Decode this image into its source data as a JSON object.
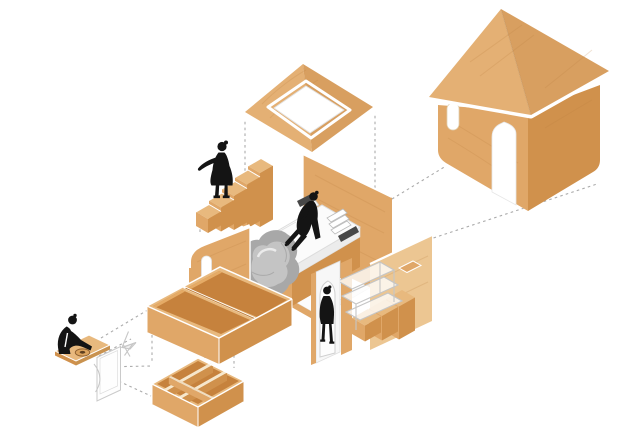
{
  "meta": {
    "caption": "Axonometric exploded diagram of a micro-cabin interior: roof panel with skylight, cabin shell with arched door, bedroom platform with bed, storage staircases, shelving boxes and a fold-out desk",
    "canvas": {
      "width": 640,
      "height": 439
    },
    "background": "#FFFFFF"
  },
  "style": {
    "colors": {
      "bg": "#FFFFFF",
      "wood_top": "#E8B97E",
      "wood_face": "#E0A768",
      "wood_side": "#D0914C",
      "wood_interior": "#C6823D",
      "wood_pale": "#F2DFC0",
      "wood_tan": "#ECC692",
      "roof_left": "#E4B074",
      "roof_right": "#D89F60",
      "outline": "#C7C7C7",
      "dash": "#ABABAB",
      "figure": "#141414",
      "blanket": "#A8A8A8",
      "blanket_light": "#C7C7C7",
      "mattress": "#FBFBFB",
      "dark_slab": "#474747"
    }
  },
  "components": [
    {
      "id": "roof-skylight-panel",
      "label": "Roof panel with square skylight opening"
    },
    {
      "id": "house-shell",
      "label": "Cabin shell with pitched roof, arched door and oval window"
    },
    {
      "id": "bedroom-platform",
      "label": "Bedroom floor platform with back wall"
    },
    {
      "id": "bed",
      "label": "Bed with mattress, pillows, books and grey blanket"
    },
    {
      "id": "storage-stairs",
      "label": "Stepped storage-box staircase"
    },
    {
      "id": "curved-wall-panel",
      "label": "Curved plywood wall panel with handle slot"
    },
    {
      "id": "drawer-boxes",
      "label": "Pair of open storage boxes"
    },
    {
      "id": "cubby-grid",
      "label": "Six-compartment cubby unit"
    },
    {
      "id": "stair-shelf-unit",
      "label": "Staircase shelf unit with arched doorway wall"
    },
    {
      "id": "fold-out-desk",
      "label": "Fold-out desk with round tray and folding panel"
    }
  ],
  "figures": [
    {
      "id": "figure-standing",
      "pose": "standing on the staircase"
    },
    {
      "id": "figure-sitting",
      "pose": "sitting on the bed"
    },
    {
      "id": "figure-walking",
      "pose": "walking through the arched doorway"
    },
    {
      "id": "figure-working",
      "pose": "seated at the fold-out desk"
    }
  ],
  "connections": {
    "style": "dashed projection lines",
    "count": 15
  }
}
